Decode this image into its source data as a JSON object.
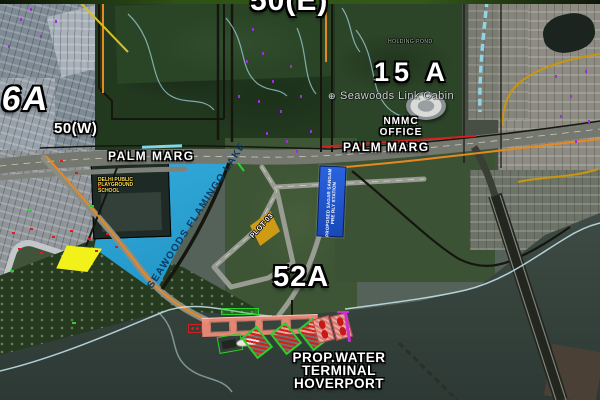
{
  "sectors": {
    "s50e": "50(E)",
    "s6a": "6A",
    "s50w": "50(W)",
    "s15a": "15 A",
    "s52a": "52A"
  },
  "roads": {
    "palm_marg_west": "PALM MARG",
    "palm_marg_east": "PALM MARG"
  },
  "places": {
    "seawoods_link_cabin": "Seawoods Link Cabin",
    "nmmc_office": [
      "NMMC",
      "OFFICE"
    ],
    "holding_pond": "HOLDING POND",
    "lake": "SEAWOODS FLAMINGO LAKE",
    "school": [
      "DELHI PUBLIC",
      "PLAYGROUND",
      "SCHOOL"
    ],
    "plot03": "PLOT-03",
    "station": [
      "PROPOSED SAGAR SANGAM",
      "PRE RLY STATION"
    ],
    "hoverport": [
      "PROP.WATER",
      "TERMINAL",
      "HOVERPORT"
    ]
  },
  "icons": {
    "link_cabin_marker": "⊕"
  },
  "colors": {
    "lake_fill": "#2BA3D4",
    "lake_text": "#0A3A63",
    "station_fill": "#1E53C8",
    "plot_fill": "#CF9B15",
    "highlight_yellow": "#F2F21A",
    "pier_fill": "#F38C7A",
    "hatch_red": "#D42020",
    "outline_green": "#2BD12B",
    "boundary_orange": "#E8891F",
    "boundary_red": "#D42020",
    "rail_cyan": "#8FD4E4",
    "magenta": "#CC2FD4",
    "label_white": "#FFFFFF"
  }
}
